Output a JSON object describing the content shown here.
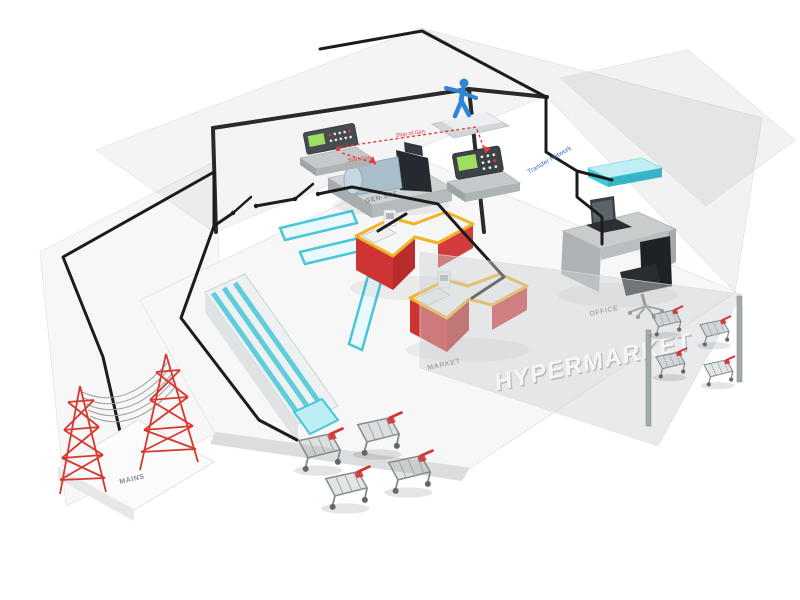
{
  "labels": {
    "mains": "MAINS",
    "genset": "GEN-SET",
    "market": "MARKET",
    "office": "OFFICE",
    "hypermarket": "HYPERMARKET",
    "signal_stop": "Stop of Gen",
    "signal_start": "Start Gen",
    "transfer_network": "Transfer Network"
  },
  "colors": {
    "cable_black": "#1c1c1c",
    "frame_dark": "#2a2a2a",
    "mains_red": "#d6392e",
    "counter_red": "#cf3434",
    "counter_trim_yellow": "#f0b428",
    "shelf_cyan": "#49c6d8",
    "ac_cyan": "#3fc9da",
    "signal_red": "#e23b3b",
    "network_blue": "#3a6fc4",
    "person_blue": "#2e86d8",
    "screen_green": "#9ede63",
    "wire_gray": "#9aa0a4"
  }
}
